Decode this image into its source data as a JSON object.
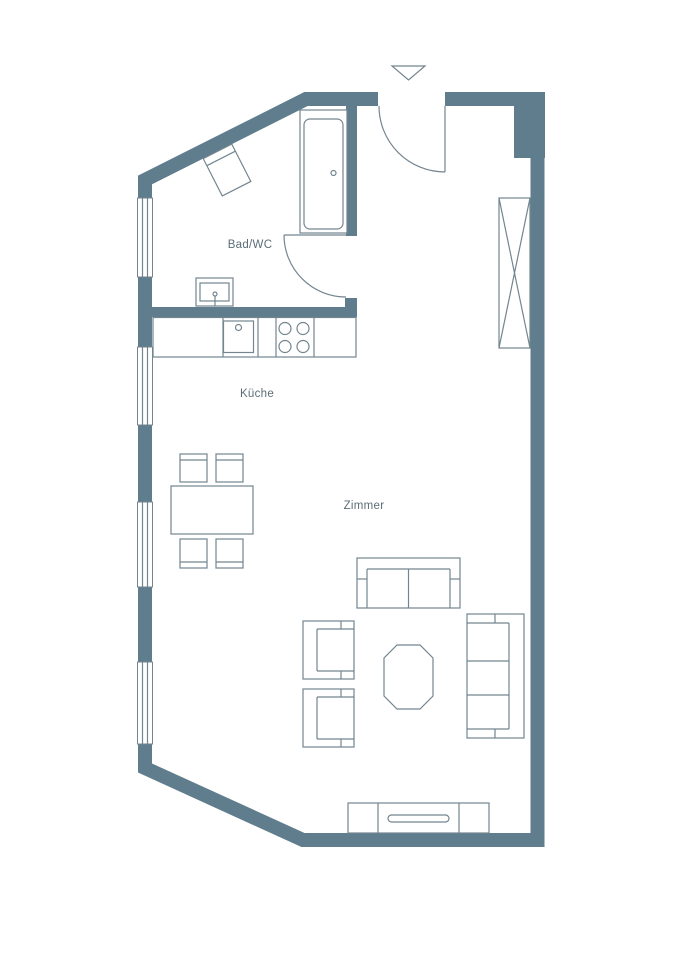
{
  "page": {
    "type": "apartment-floor-plan",
    "background": "#ffffff"
  },
  "colors": {
    "wall": "#5f7d8c",
    "outline": "#73858f",
    "label_text": "#5b6d77"
  },
  "labels": {
    "bathroom": "Bad/WC",
    "kitchen": "Küche",
    "living_room": "Zimmer"
  },
  "elements": {
    "entrance_marker": "down-triangle",
    "doors": [
      "entrance-door",
      "bathroom-door"
    ],
    "windows_on_left_wall": 4,
    "bathroom_fixtures": [
      "bathtub",
      "washbasin",
      "wc-angled"
    ],
    "kitchen_fixtures": [
      "countertop",
      "kitchen-sink",
      "stove-4-burners"
    ],
    "furniture": [
      "wardrobe",
      "dining-table",
      "dining-chairs-4",
      "two-seat-sofa",
      "armchairs-2",
      "coffee-table",
      "three-seat-sofa",
      "sideboard"
    ]
  }
}
